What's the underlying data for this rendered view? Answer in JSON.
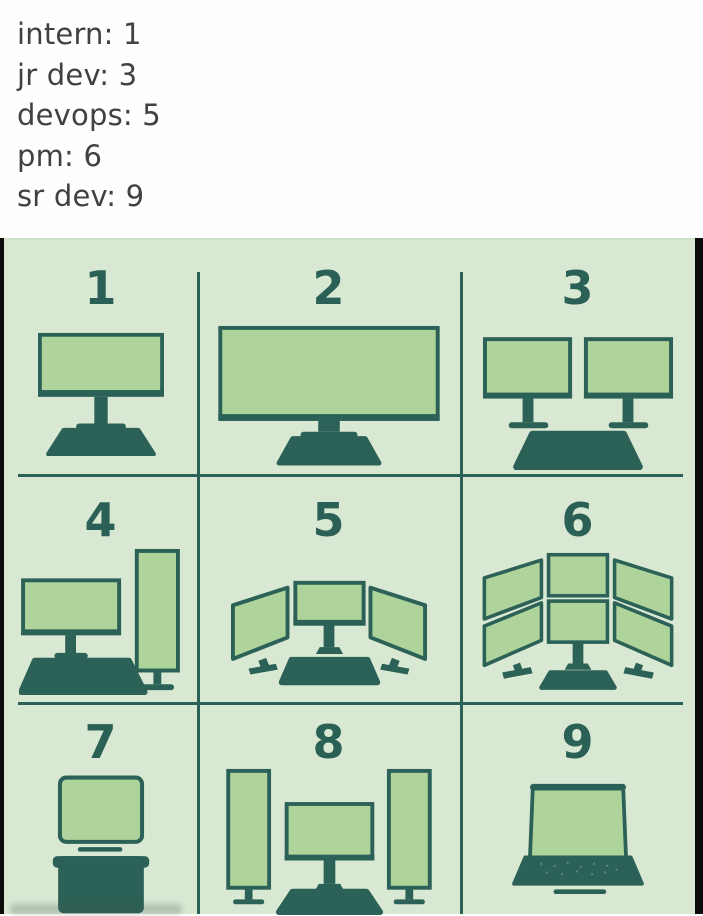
{
  "header": {
    "lines": [
      "intern: 1",
      "jr dev: 3",
      "devops: 5",
      "pm: 6",
      "sr dev: 9"
    ]
  },
  "grid": {
    "cells": [
      {
        "number": "1",
        "icon": "single-monitor"
      },
      {
        "number": "2",
        "icon": "ultrawide-monitor"
      },
      {
        "number": "3",
        "icon": "dual-monitors"
      },
      {
        "number": "4",
        "icon": "monitor-plus-vertical-monitor"
      },
      {
        "number": "5",
        "icon": "triple-monitors"
      },
      {
        "number": "6",
        "icon": "six-monitor-wall"
      },
      {
        "number": "7",
        "icon": "crt-monitor-on-tower"
      },
      {
        "number": "8",
        "icon": "two-vertical-plus-center-monitor"
      },
      {
        "number": "9",
        "icon": "laptop"
      }
    ]
  },
  "colors": {
    "header_bg": "#fefefe",
    "header_text": "#414141",
    "panel_bg": "#d9e8d3",
    "screen_fill": "#aed39b",
    "dark_teal": "#2b6156",
    "number_color": "#2a6055",
    "frame_black": "#0b0b0b"
  }
}
